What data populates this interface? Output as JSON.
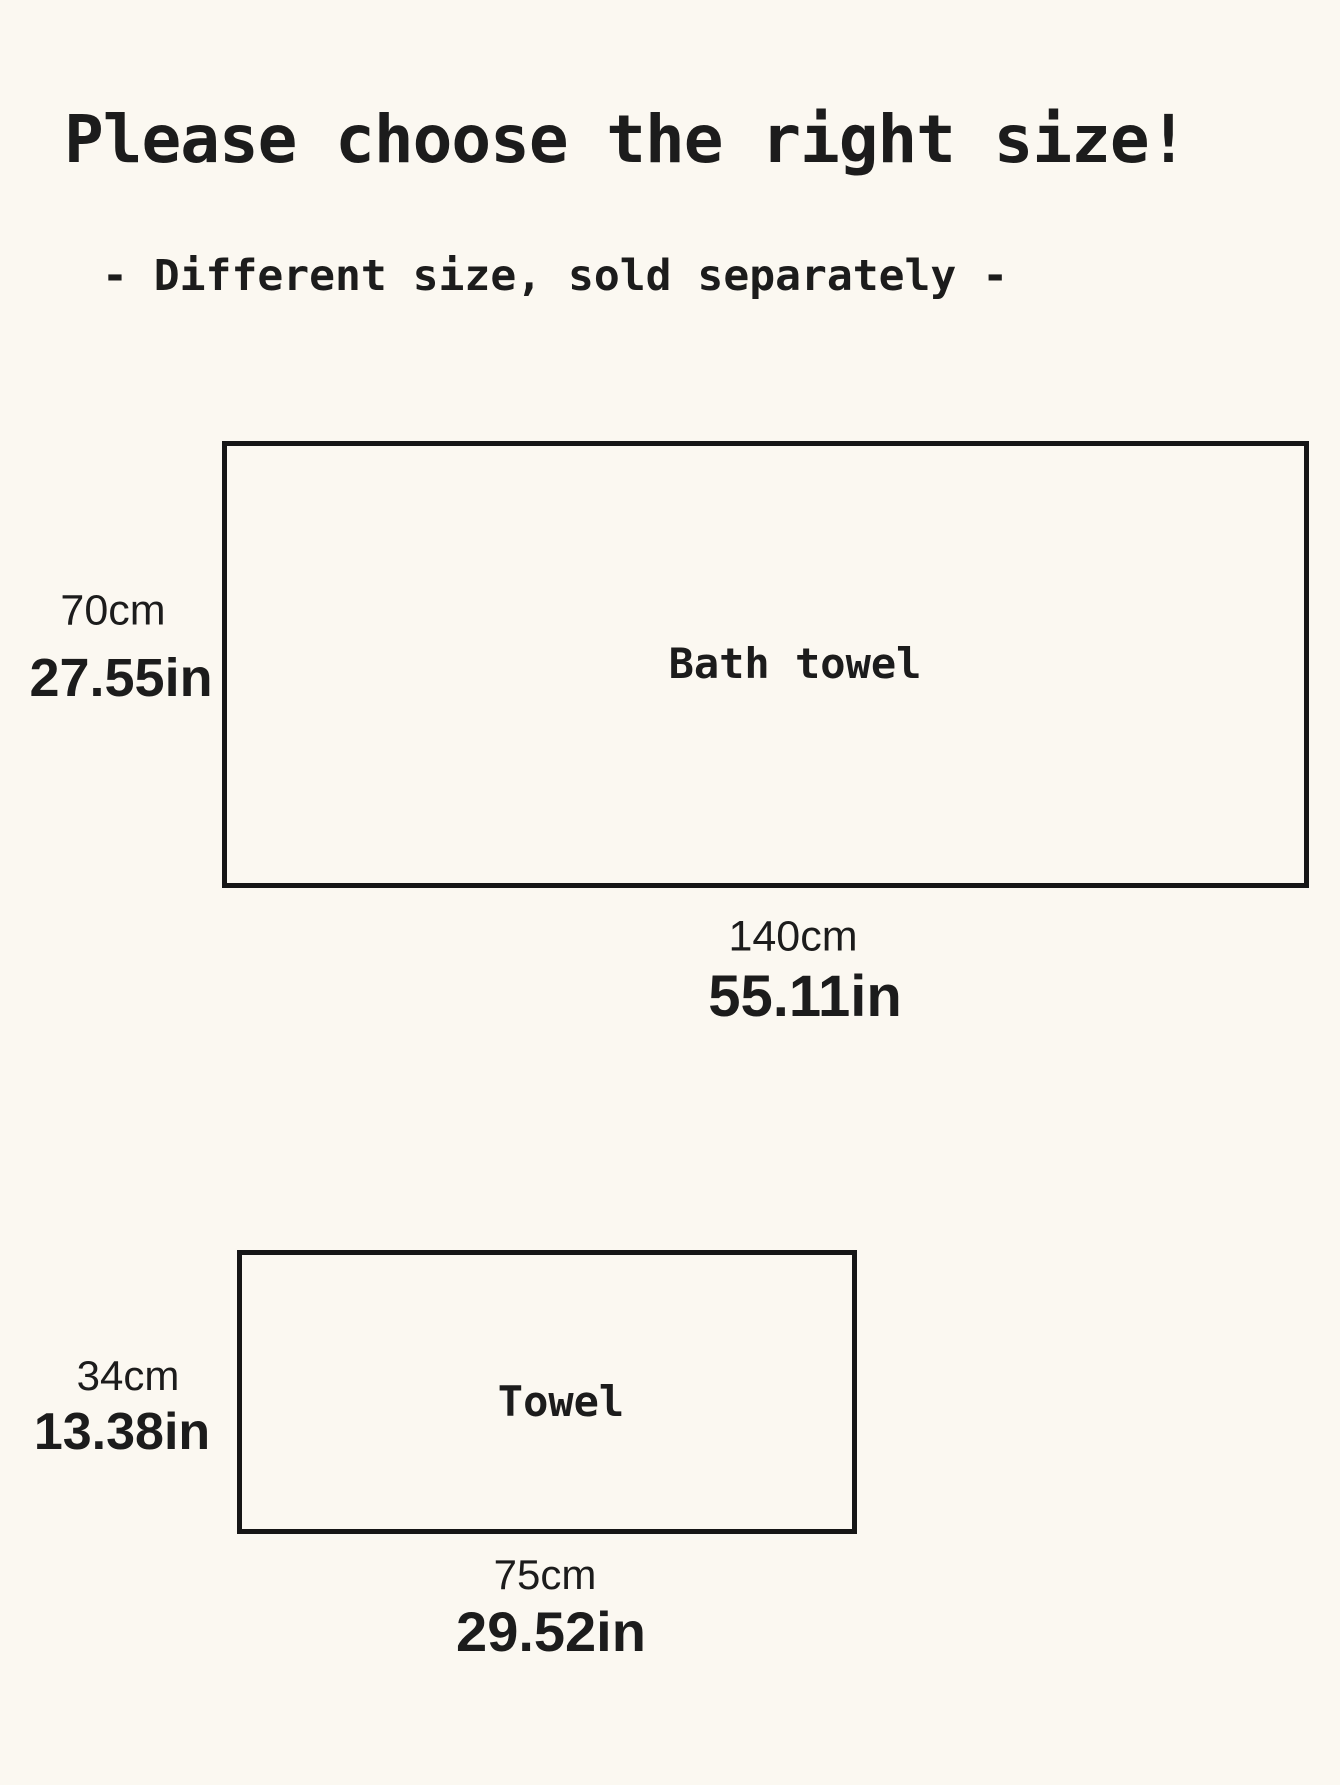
{
  "page": {
    "title": "Please choose the right size!",
    "subtitle": "- Different size, sold separately -",
    "background_color": "#fbf8f1",
    "text_color": "#1c1c1c",
    "outline_color": "#161616"
  },
  "diagrams": [
    {
      "name": "Bath towel",
      "height_cm": "70cm",
      "height_in": "27.55in",
      "width_cm": "140cm",
      "width_in": "55.11in"
    },
    {
      "name": "Towel",
      "height_cm": "34cm",
      "height_in": "13.38in",
      "width_cm": "75cm",
      "width_in": "29.52in"
    }
  ]
}
